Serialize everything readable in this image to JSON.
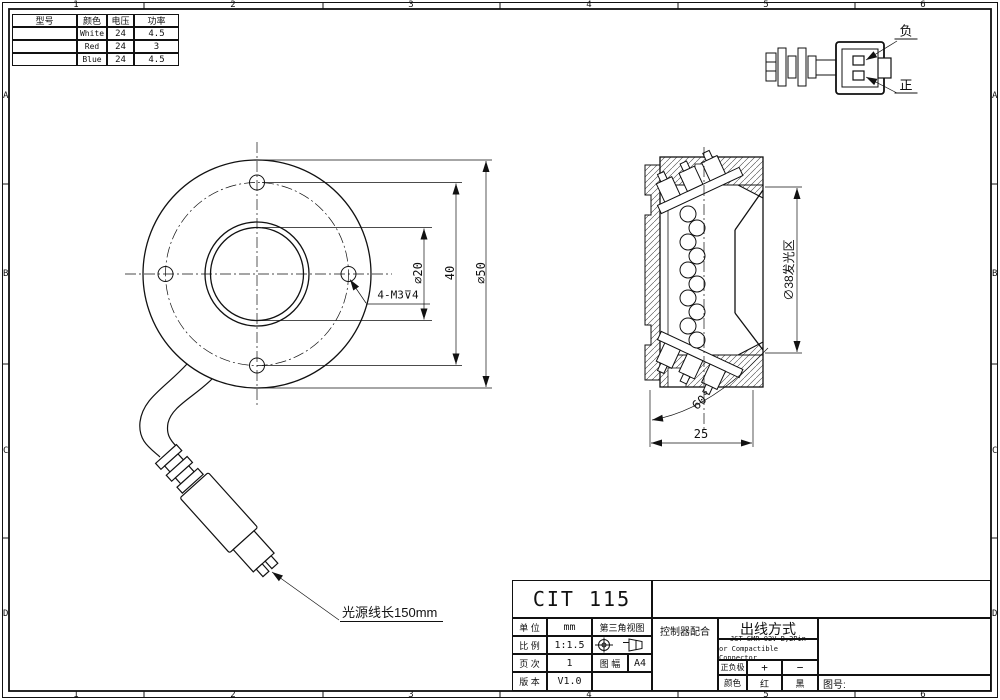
{
  "border": {
    "columns": [
      "1",
      "2",
      "3",
      "4",
      "5",
      "6"
    ],
    "rows": [
      "A",
      "B",
      "C",
      "D"
    ]
  },
  "spec_table": {
    "headers": [
      "型号",
      "颜色",
      "电压",
      "功率"
    ],
    "rows": [
      [
        "",
        "White",
        "24",
        "4.5"
      ],
      [
        "",
        "Red",
        "24",
        "3"
      ],
      [
        "",
        "Blue",
        "24",
        "4.5"
      ]
    ]
  },
  "connector_detail": {
    "negative_label": "负",
    "positive_label": "正"
  },
  "front_view": {
    "dim_inner": "∅20",
    "dim_bolt_circle": "40",
    "dim_outer": "∅50",
    "thread_note": "4-M3⊽4",
    "cable_note": "光源线长150mm"
  },
  "side_view": {
    "dim_emitting_area": "∅38发光区",
    "dim_angle": "60°",
    "dim_depth": "25"
  },
  "title_block": {
    "model": "CIT 115",
    "unit_label": "单 位",
    "unit_value": "mm",
    "scale_label": "比 例",
    "scale_value": "1:1.5",
    "page_label": "页 次",
    "page_value": "1",
    "version_label": "版 本",
    "version_value": "V1.0",
    "projection_label": "第三角视图",
    "sheet_label": "图 幅",
    "sheet_value": "A4",
    "controller_label": "控制器配合",
    "wiring_label": "出线方式",
    "connector_line1": "JST SMR-02V-B,2Pin",
    "connector_line2": "or Compactible Connector",
    "polarity_label": "正负极",
    "polarity_positive": "+",
    "polarity_negative": "−",
    "color_label": "颜色",
    "color_positive": "红",
    "color_negative": "黑",
    "drawing_no_label": "图号:"
  }
}
